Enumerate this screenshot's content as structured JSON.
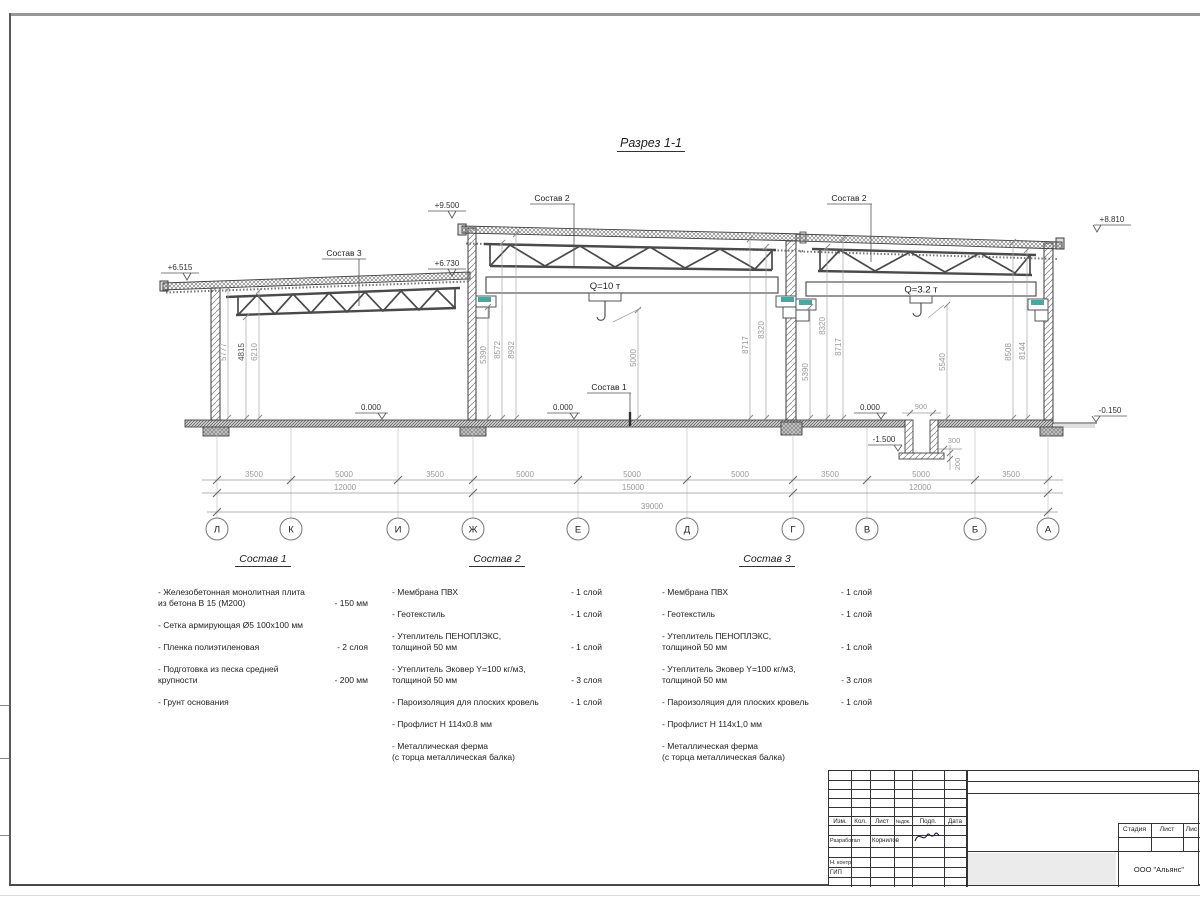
{
  "sheet": {
    "title": "Разрез 1-1"
  },
  "colors": {
    "line": "#444444",
    "dim_text": "#9a9a9a",
    "accent_teal": "#46a8a2"
  },
  "drawing": {
    "elevations": {
      "left_eave": "+6.515",
      "left_ridge": "+6.730",
      "mid_top": "+9.500",
      "right_top": "+8.810",
      "floor": "0.000",
      "ground": "-0.150",
      "pit_bottom": "-1.500"
    },
    "cranes": {
      "big": "Q=10 т",
      "small": "Q=3.2 т"
    },
    "callouts": {
      "c1": "Состав 1",
      "c2": "Состав 2",
      "c3": "Состав 3"
    },
    "vdims": {
      "l1": "5777",
      "l2": "4815",
      "l3": "6210",
      "m1": "5390",
      "m2": "8572",
      "m3": "8932",
      "hook1": "5000",
      "c1": "8717",
      "c2": "8320",
      "c3": "5390",
      "c4": "8320",
      "c5": "8717",
      "hook2": "5540",
      "r1": "8508",
      "r2": "8144"
    },
    "pit": {
      "width": "900",
      "wall": "300",
      "slab": "200"
    }
  },
  "grid": {
    "axes": [
      "Л",
      "К",
      "И",
      "Ж",
      "Е",
      "Д",
      "Г",
      "В",
      "Б",
      "А"
    ],
    "row1": [
      "3500",
      "5000",
      "3500",
      "5000",
      "5000",
      "5000",
      "3500",
      "5000",
      "3500"
    ],
    "row2": [
      "12000",
      "15000",
      "12000"
    ],
    "total": "39000"
  },
  "compositions": [
    {
      "title": "Состав 1",
      "items": [
        {
          "text": "- Железобетонная  монолитная плита\nиз бетона В 15 (М200)",
          "value": "- 150 мм"
        },
        {
          "text": "- Сетка армирующая Ø5 100x100 мм",
          "value": ""
        },
        {
          "text": "- Пленка полиэтиленовая",
          "value": "-  2 слоя"
        },
        {
          "text": "- Подготовка из песка средней\nкрупности",
          "value": "- 200 мм"
        },
        {
          "text": "- Грунт основания",
          "value": ""
        }
      ]
    },
    {
      "title": "Состав 2",
      "items": [
        {
          "text": "- Мембрана ПВХ",
          "value": "- 1 слой"
        },
        {
          "text": "- Геотекстиль",
          "value": "- 1 слой"
        },
        {
          "text": "- Утеплитель ПЕНОПЛЭКС,\nтолщиной 50 мм",
          "value": "- 1 слой"
        },
        {
          "text": "- Утеплитель Эковер Y=100 кг/м3,\nтолщиной 50 мм",
          "value": "- 3 слоя"
        },
        {
          "text": "- Пароизоляция для плоских кровель",
          "value": "- 1 слой"
        },
        {
          "text": "- Профлист Н 114х0.8 мм",
          "value": ""
        },
        {
          "text": "- Металлическая ферма\n(с торца металлическая балка)",
          "value": ""
        }
      ]
    },
    {
      "title": "Состав 3",
      "items": [
        {
          "text": "- Мембрана ПВХ",
          "value": "- 1 слой"
        },
        {
          "text": "- Геотекстиль",
          "value": "- 1 слой"
        },
        {
          "text": "- Утеплитель ПЕНОПЛЭКС,\nтолщиной 50 мм",
          "value": "- 1 слой"
        },
        {
          "text": "- Утеплитель Эковер Y=100 кг/м3,\nтолщиной 50 мм",
          "value": "- 3 слоя"
        },
        {
          "text": "- Пароизоляция для плоских кровель",
          "value": "- 1 слой"
        },
        {
          "text": "- Профлист Н 114х1,0 мм",
          "value": ""
        },
        {
          "text": "- Металлическая ферма\n(с торца металлическая балка)",
          "value": ""
        }
      ]
    }
  ],
  "titleblock": {
    "header": {
      "izm": "Изм.",
      "kol": "Кол.",
      "list": "Лист",
      "ndok": "№док.",
      "podp": "Подп.",
      "data": "Дата"
    },
    "developed_label": "Разработал",
    "developed_name": "Корнилов",
    "ncontr": "Н. контр.",
    "gip": "ГИП",
    "stage": {
      "stadia": "Стадия",
      "list": "Лист",
      "listov": "Лис"
    },
    "company": "ООО \"Альянс\""
  }
}
